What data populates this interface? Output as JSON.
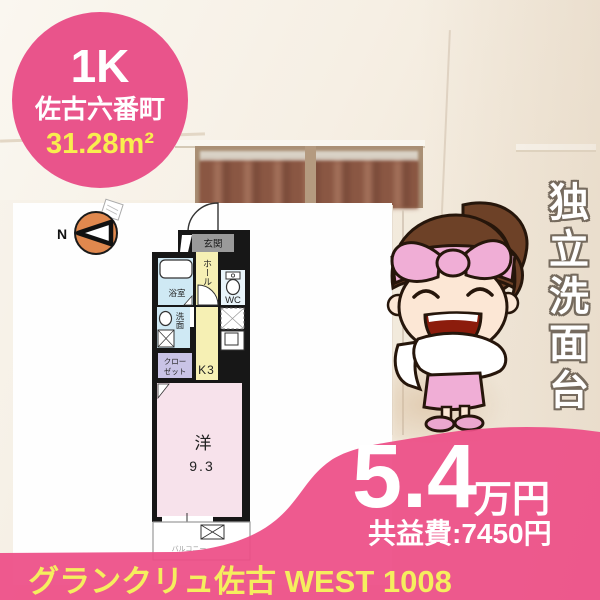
{
  "badge": {
    "plan": "1K",
    "town": "佐古六番町",
    "area": "31.28m²"
  },
  "ribbon": {
    "text": "独立洗面台"
  },
  "price": {
    "rent": "5.4",
    "unit": "万円",
    "fee": "共益費:7450円"
  },
  "footer": {
    "title": "グランクリュ佐古 WEST 1008"
  },
  "floorplan": {
    "compass": "N",
    "genkan": "玄関",
    "hall": "ホール",
    "bath": "浴室",
    "wc": "WC",
    "washroom": "洗面",
    "kitchen": "K3",
    "closet_line1": "クロー",
    "closet_line2": "ゼット",
    "room": "洋",
    "room_size": "9.3",
    "balcony": "バルコニー"
  },
  "colors": {
    "accent_pink": "#ed4e86",
    "accent_yellow": "#f5ee5e",
    "plan_yellow": "#f6f0b4",
    "plan_blue": "#cfe9f4",
    "plan_lavender": "#c9c3e6",
    "plan_pink": "#f7e2eb"
  }
}
